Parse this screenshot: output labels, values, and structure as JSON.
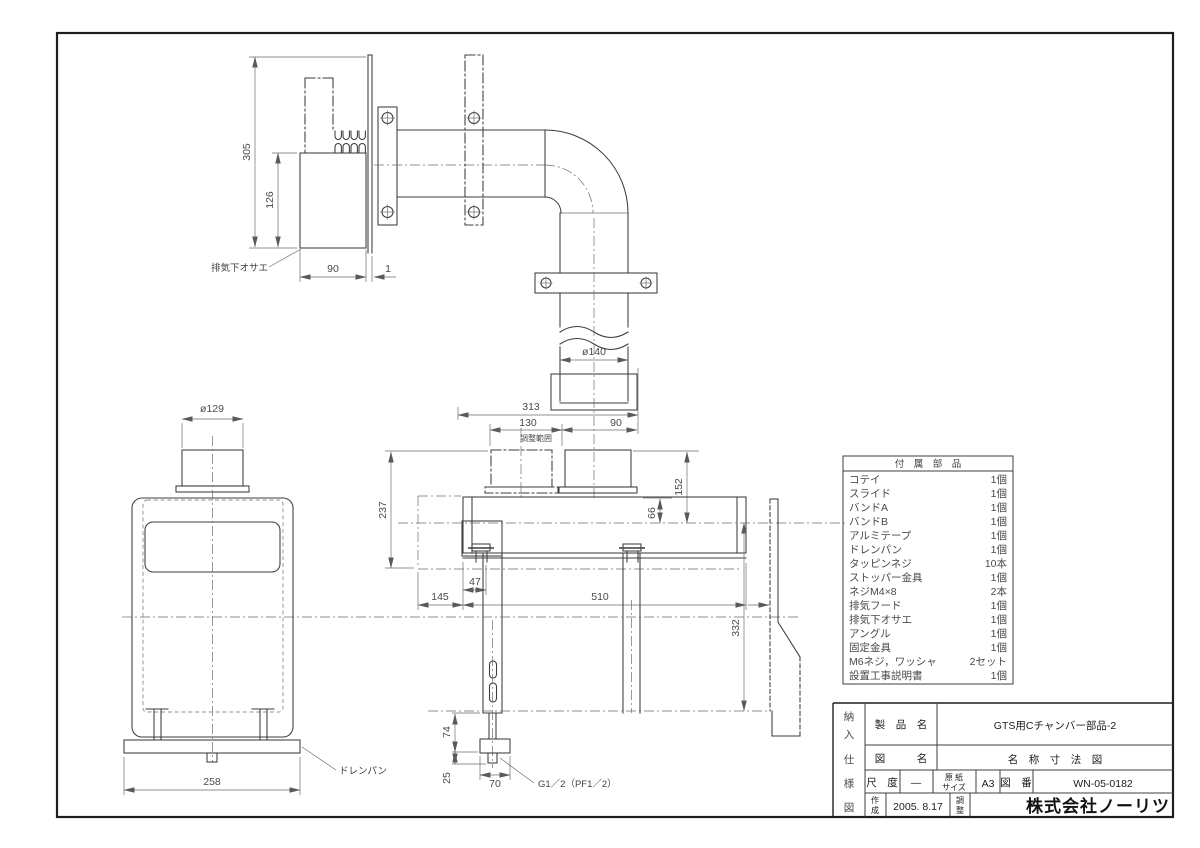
{
  "doc": {
    "type": "technical-drawing"
  },
  "dims": {
    "v305": "305",
    "v126": "126",
    "v90_side": "90",
    "v1": "1",
    "dia140": "ø140",
    "v313": "313",
    "v130": "130",
    "v90_top": "90",
    "adjust_range": "調整範囲",
    "v152": "152",
    "v66": "66",
    "v237": "237",
    "v47": "47",
    "v145": "145",
    "v510": "510",
    "v332": "332",
    "v74": "74",
    "v25": "25",
    "v70": "70",
    "drain_thread": "G1／2（PF1／2）",
    "dia129": "ø129",
    "v258": "258"
  },
  "labels": {
    "exhaust_holder": "排気下オサエ",
    "drain_pan": "ドレンパン"
  },
  "parts_table": {
    "title": "付　属　部　品",
    "rows": [
      [
        "コテイ",
        "1個"
      ],
      [
        "スライド",
        "1個"
      ],
      [
        "バンドA",
        "1個"
      ],
      [
        "バンドB",
        "1個"
      ],
      [
        "アルミテープ",
        "1個"
      ],
      [
        "ドレンパン",
        "1個"
      ],
      [
        "タッピンネジ",
        "10本"
      ],
      [
        "ストッパー金具",
        "1個"
      ],
      [
        "ネジM4×8",
        "2本"
      ],
      [
        "排気フード",
        "1個"
      ],
      [
        "排気下オサエ",
        "1個"
      ],
      [
        "アングル",
        "1個"
      ],
      [
        "固定金具",
        "1個"
      ],
      [
        "M6ネジ，ワッシャ",
        "2セット"
      ],
      [
        "設置工事説明書",
        "1個"
      ]
    ]
  },
  "title_block": {
    "doc_type": [
      "納",
      "入",
      "仕",
      "様",
      "図"
    ],
    "product_label": "製　品　名",
    "product_name": "GTS用Cチャンバー部品-2",
    "drawing_label": "図　　　名",
    "drawing_name": "名　称　寸　法　図",
    "scale_label": "尺　度",
    "scale_value": "―",
    "paper_label": [
      "原 紙",
      "サイズ"
    ],
    "paper_size": "A3",
    "number_label": "図　番",
    "number_value": "WN-05-0182",
    "created_label": [
      "作",
      "成"
    ],
    "created_date": "2005. 8.17",
    "adjust_label": [
      "調",
      "整"
    ],
    "company": "株式会社ノーリツ"
  }
}
